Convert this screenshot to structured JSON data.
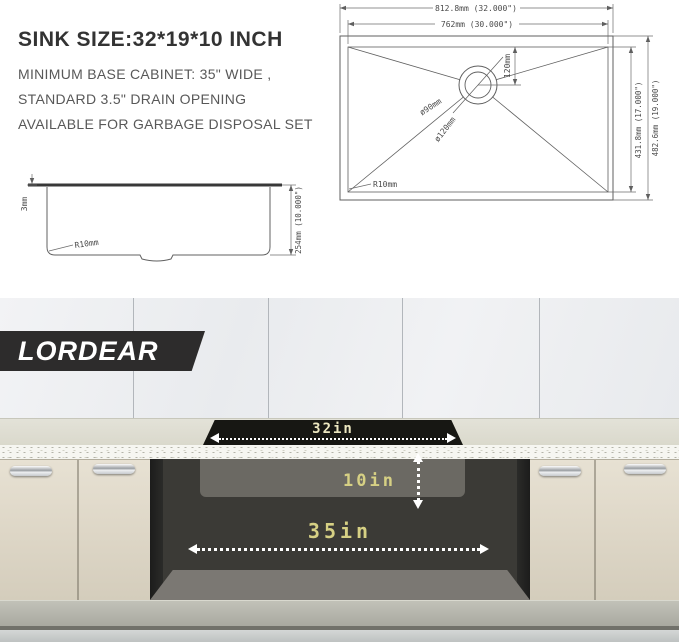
{
  "info": {
    "title": "SINK SIZE:32*19*10 INCH",
    "line1": "MINIMUM BASE CABINET: 35\" WIDE ,",
    "line2": "STANDARD 3.5\" DRAIN OPENING",
    "line3": "AVAILABLE FOR GARBAGE DISPOSAL SET"
  },
  "top_view": {
    "dim_outer_width": "812.8mm (32.000\")",
    "dim_inner_width": "762mm (30.000\")",
    "dim_drain_offset": "120mm",
    "dim_drain_inner": "ø90mm",
    "dim_drain_outer": "ø120mm",
    "dim_corner_radius": "R10mm",
    "dim_inner_length": "431.8mm (17.000\")",
    "dim_outer_length": "482.6mm (19.000\")"
  },
  "side_view": {
    "dim_rim_thickness": "3mm",
    "dim_corner_radius": "R10mm",
    "dim_depth": "254mm (10.000\")"
  },
  "scene": {
    "brand": "LORDEAR",
    "dim_sink_width": "32in",
    "dim_sink_depth": "10in",
    "dim_cabinet_width": "35in"
  },
  "colors": {
    "banner_black": "#2d2c2c",
    "label_yellow": "#d6d084",
    "label_cream": "#ece7c0",
    "drawing_line": "#5f5f5f",
    "cabinet_cream": "#ddd6c6",
    "opening_dark": "#3b3a36"
  }
}
